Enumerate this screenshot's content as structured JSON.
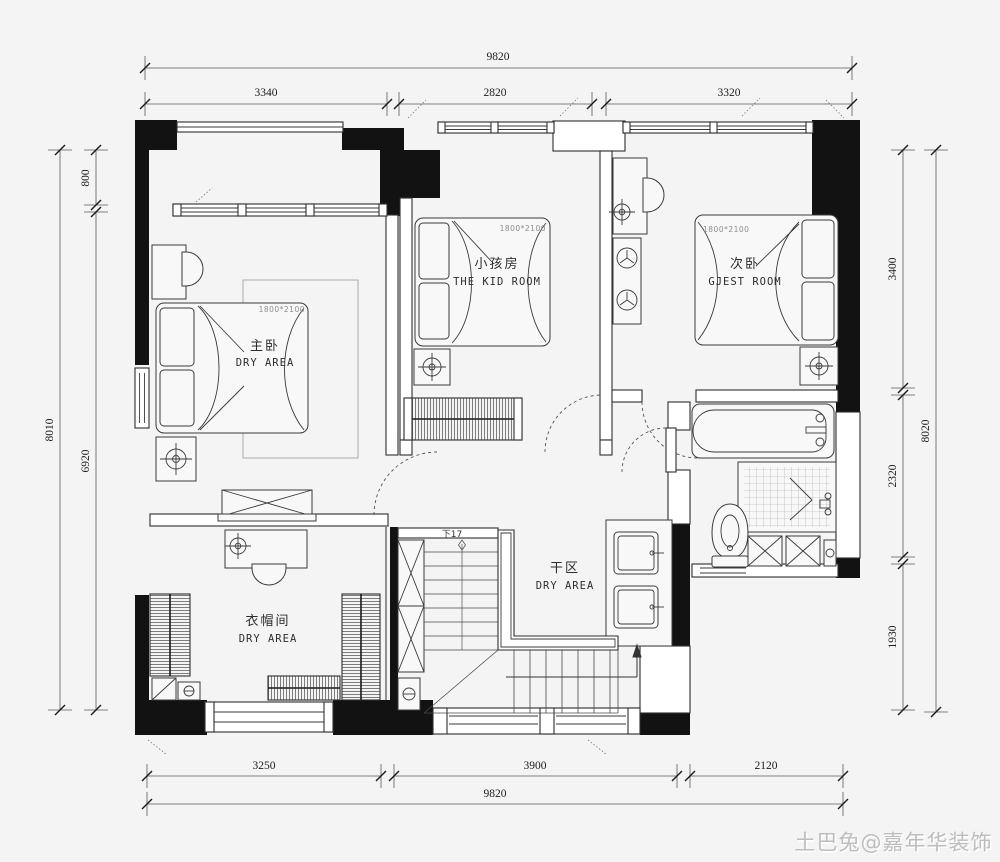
{
  "watermark": "土巴兔@嘉年华装饰",
  "rooms": {
    "master": {
      "zh": "主卧",
      "en": "DRY AREA",
      "bed": "1800*2100"
    },
    "kid": {
      "zh": "小孩房",
      "en": "THE KID ROOM",
      "bed": "1800*2100"
    },
    "guest": {
      "zh": "次卧",
      "en": "GJEST ROOM",
      "bed": "1800*2100"
    },
    "cloak": {
      "zh": "衣帽间",
      "en": "DRY AREA"
    },
    "dry": {
      "zh": "干区",
      "en": "DRY AREA"
    }
  },
  "stairs": {
    "down_label": "下17"
  },
  "dims": {
    "top_total": "9820",
    "top_segs": [
      "3340",
      "2820",
      "3320"
    ],
    "bottom_total": "9820",
    "bottom_segs": [
      "3250",
      "3900",
      "2120"
    ],
    "left_total": "8010",
    "left_segs": [
      "800",
      "6920"
    ],
    "right_total": "8020",
    "right_segs": [
      "3400",
      "2320",
      "1930"
    ]
  },
  "colors": {
    "wall": "#121212",
    "line": "#3a3a3a",
    "dim": "#5a5a5a",
    "background": "#f3f4f3",
    "watermark": "#bdbdbd"
  }
}
